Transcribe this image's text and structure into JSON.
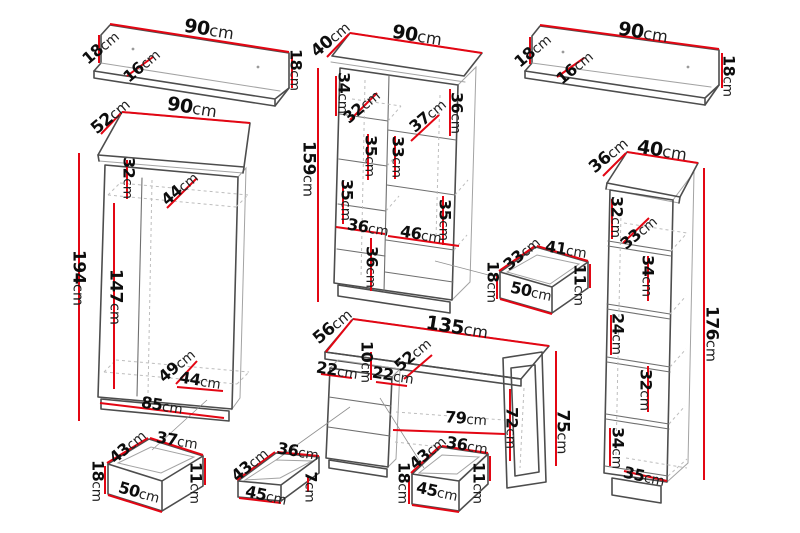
{
  "unit": "cm",
  "colors": {
    "dimension_line": "#e30613",
    "outline_dark": "#4d4d4d",
    "outline_light": "#a3a3a3",
    "hidden_line": "#bdbdbd",
    "label_text": "#0d0d0d"
  },
  "pieces": [
    {
      "id": "wall-shelf-left",
      "labels": [
        {
          "v": "90",
          "x": 209,
          "y": 30,
          "r": 9,
          "s": 19
        },
        {
          "v": "18",
          "x": 101,
          "y": 48,
          "r": -40,
          "s": 16
        },
        {
          "v": "16",
          "x": 142,
          "y": 66,
          "r": -40,
          "s": 16
        },
        {
          "v": "18",
          "x": 295,
          "y": 70,
          "r": 90,
          "s": 16
        }
      ]
    },
    {
      "id": "tall-cabinet-center",
      "labels": [
        {
          "v": "40",
          "x": 331,
          "y": 40,
          "r": -40,
          "s": 17
        },
        {
          "v": "90",
          "x": 417,
          "y": 36,
          "r": 9,
          "s": 19
        },
        {
          "v": "159",
          "x": 308,
          "y": 169,
          "r": 90,
          "s": 17
        },
        {
          "v": "34",
          "x": 343,
          "y": 93,
          "r": 90,
          "s": 16
        },
        {
          "v": "32",
          "x": 362,
          "y": 107,
          "r": -40,
          "s": 16
        },
        {
          "v": "36",
          "x": 456,
          "y": 113,
          "r": 90,
          "s": 16
        },
        {
          "v": "37",
          "x": 428,
          "y": 116,
          "r": -40,
          "s": 16
        },
        {
          "v": "33",
          "x": 397,
          "y": 157,
          "r": 90,
          "s": 16
        },
        {
          "v": "35",
          "x": 370,
          "y": 156,
          "r": 90,
          "s": 16
        },
        {
          "v": "35",
          "x": 346,
          "y": 200,
          "r": 90,
          "s": 16
        },
        {
          "v": "36",
          "x": 368,
          "y": 228,
          "r": 9,
          "s": 16
        },
        {
          "v": "46",
          "x": 421,
          "y": 235,
          "r": 9,
          "s": 16
        },
        {
          "v": "35",
          "x": 444,
          "y": 220,
          "r": 90,
          "s": 16
        },
        {
          "v": "36",
          "x": 371,
          "y": 267,
          "r": 90,
          "s": 16
        }
      ]
    },
    {
      "id": "wall-shelf-right",
      "labels": [
        {
          "v": "90",
          "x": 643,
          "y": 33,
          "r": 9,
          "s": 19
        },
        {
          "v": "18",
          "x": 533,
          "y": 51,
          "r": -40,
          "s": 16
        },
        {
          "v": "16",
          "x": 575,
          "y": 68,
          "r": -40,
          "s": 16
        },
        {
          "v": "18",
          "x": 728,
          "y": 76,
          "r": 90,
          "s": 16
        }
      ]
    },
    {
      "id": "wardrobe-left",
      "labels": [
        {
          "v": "52",
          "x": 111,
          "y": 117,
          "r": -40,
          "s": 17
        },
        {
          "v": "90",
          "x": 192,
          "y": 108,
          "r": 9,
          "s": 19
        },
        {
          "v": "32",
          "x": 128,
          "y": 178,
          "r": 90,
          "s": 16
        },
        {
          "v": "44",
          "x": 180,
          "y": 189,
          "r": -40,
          "s": 16
        },
        {
          "v": "194",
          "x": 78,
          "y": 278,
          "r": 90,
          "s": 17
        },
        {
          "v": "147",
          "x": 115,
          "y": 297,
          "r": 90,
          "s": 17
        },
        {
          "v": "49",
          "x": 177,
          "y": 366,
          "r": -40,
          "s": 16
        },
        {
          "v": "44",
          "x": 200,
          "y": 381,
          "r": 9,
          "s": 16
        },
        {
          "v": "85",
          "x": 162,
          "y": 406,
          "r": 9,
          "s": 16
        }
      ]
    },
    {
      "id": "drawer-under-wardrobe",
      "labels": [
        {
          "v": "43",
          "x": 128,
          "y": 447,
          "r": -40,
          "s": 16
        },
        {
          "v": "37",
          "x": 177,
          "y": 441,
          "r": 9,
          "s": 16
        },
        {
          "v": "18",
          "x": 97,
          "y": 481,
          "r": 90,
          "s": 16
        },
        {
          "v": "50",
          "x": 139,
          "y": 493,
          "r": 15,
          "s": 16
        },
        {
          "v": "11",
          "x": 195,
          "y": 483,
          "r": 90,
          "s": 16
        }
      ]
    },
    {
      "id": "desk",
      "labels": [
        {
          "v": "56",
          "x": 333,
          "y": 327,
          "r": -40,
          "s": 17
        },
        {
          "v": "135",
          "x": 457,
          "y": 328,
          "r": 9,
          "s": 19
        },
        {
          "v": "22",
          "x": 337,
          "y": 371,
          "r": 9,
          "s": 16
        },
        {
          "v": "10",
          "x": 366,
          "y": 362,
          "r": 90,
          "s": 16
        },
        {
          "v": "22",
          "x": 393,
          "y": 376,
          "r": 9,
          "s": 16
        },
        {
          "v": "52",
          "x": 413,
          "y": 355,
          "r": -40,
          "s": 16
        },
        {
          "v": "79",
          "x": 466,
          "y": 419,
          "r": 4,
          "s": 16
        },
        {
          "v": "72",
          "x": 511,
          "y": 428,
          "r": 90,
          "s": 16
        },
        {
          "v": "75",
          "x": 562,
          "y": 432,
          "r": 90,
          "s": 17
        }
      ]
    },
    {
      "id": "drawer-shallow-center",
      "labels": [
        {
          "v": "43",
          "x": 250,
          "y": 465,
          "r": -40,
          "s": 16
        },
        {
          "v": "36",
          "x": 298,
          "y": 452,
          "r": 9,
          "s": 16
        },
        {
          "v": "45",
          "x": 266,
          "y": 496,
          "r": 12,
          "s": 16
        },
        {
          "v": "7",
          "x": 310,
          "y": 487,
          "r": 90,
          "s": 16
        }
      ]
    },
    {
      "id": "drawer-center",
      "labels": [
        {
          "v": "43",
          "x": 428,
          "y": 453,
          "r": -40,
          "s": 16
        },
        {
          "v": "36",
          "x": 467,
          "y": 446,
          "r": 9,
          "s": 16
        },
        {
          "v": "18",
          "x": 403,
          "y": 483,
          "r": 90,
          "s": 16
        },
        {
          "v": "45",
          "x": 437,
          "y": 492,
          "r": 12,
          "s": 16
        },
        {
          "v": "11",
          "x": 478,
          "y": 483,
          "r": 90,
          "s": 16
        }
      ]
    },
    {
      "id": "drawer-right",
      "labels": [
        {
          "v": "33",
          "x": 522,
          "y": 254,
          "r": -40,
          "s": 16
        },
        {
          "v": "41",
          "x": 566,
          "y": 250,
          "r": 9,
          "s": 16
        },
        {
          "v": "18",
          "x": 492,
          "y": 282,
          "r": 90,
          "s": 16
        },
        {
          "v": "50",
          "x": 531,
          "y": 292,
          "r": 12,
          "s": 16
        },
        {
          "v": "11",
          "x": 579,
          "y": 285,
          "r": 90,
          "s": 16
        }
      ]
    },
    {
      "id": "bookcase-right",
      "labels": [
        {
          "v": "36",
          "x": 609,
          "y": 156,
          "r": -40,
          "s": 17
        },
        {
          "v": "40",
          "x": 662,
          "y": 151,
          "r": 9,
          "s": 19
        },
        {
          "v": "32",
          "x": 616,
          "y": 217,
          "r": 90,
          "s": 16
        },
        {
          "v": "33",
          "x": 639,
          "y": 233,
          "r": -40,
          "s": 16
        },
        {
          "v": "34",
          "x": 647,
          "y": 276,
          "r": 90,
          "s": 16
        },
        {
          "v": "24",
          "x": 617,
          "y": 334,
          "r": 90,
          "s": 16
        },
        {
          "v": "32",
          "x": 645,
          "y": 390,
          "r": 90,
          "s": 16
        },
        {
          "v": "34",
          "x": 617,
          "y": 448,
          "r": 90,
          "s": 16
        },
        {
          "v": "35",
          "x": 644,
          "y": 477,
          "r": 12,
          "s": 16
        },
        {
          "v": "176",
          "x": 711,
          "y": 334,
          "r": 90,
          "s": 17
        }
      ]
    }
  ]
}
